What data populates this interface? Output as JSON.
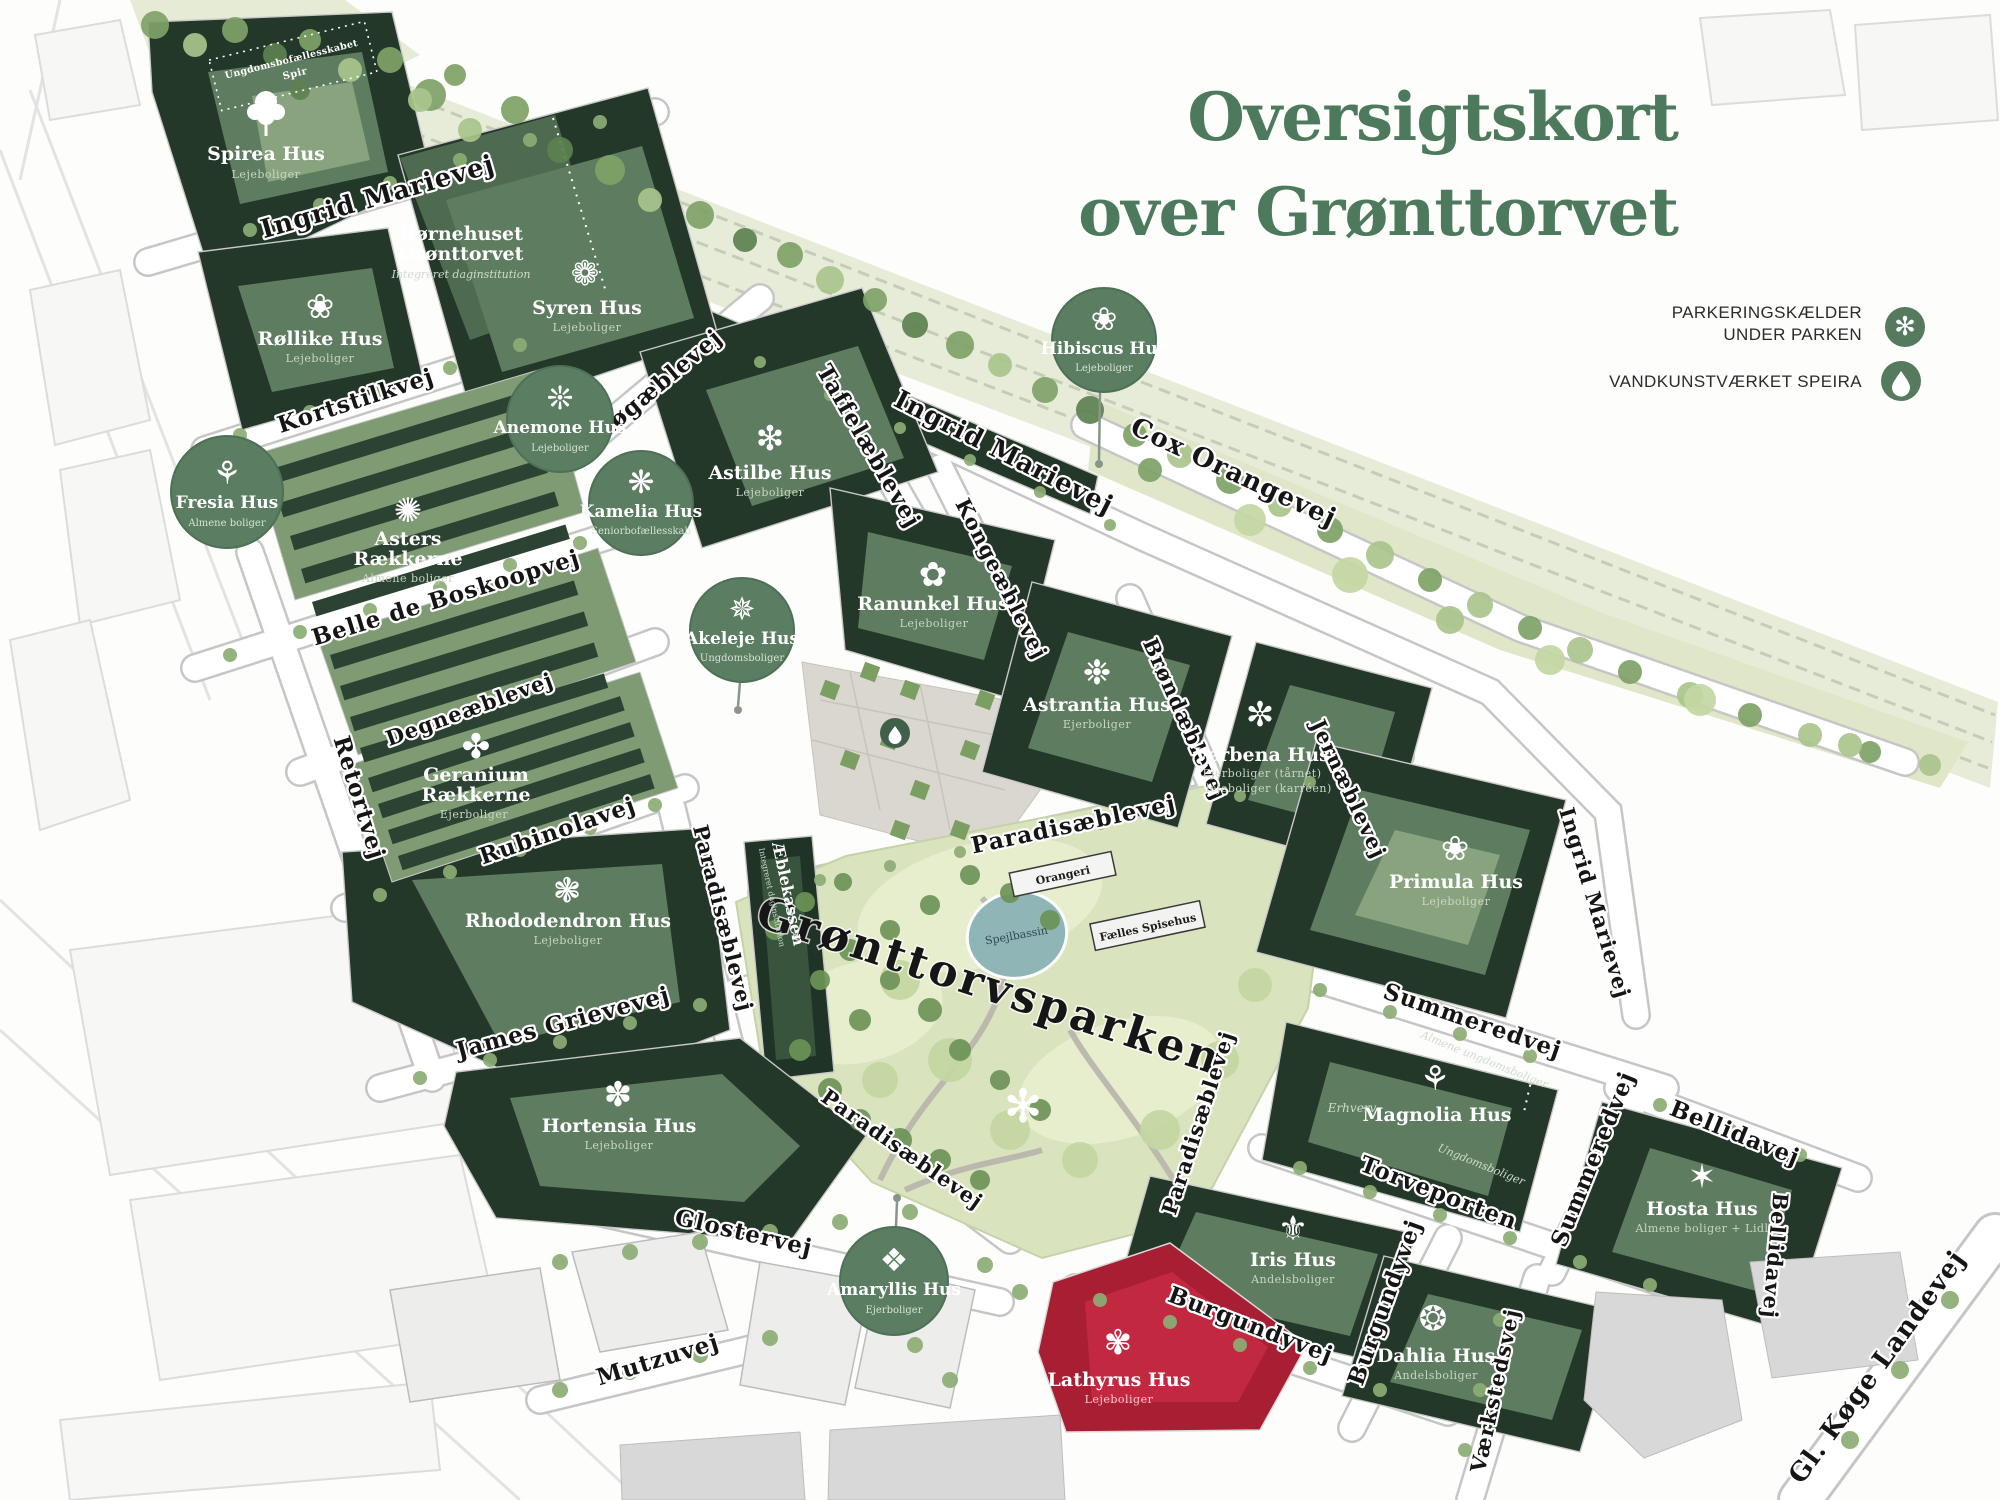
{
  "title": {
    "line1": "Oversigtskort",
    "line2": "over Grønttorvet"
  },
  "legend": [
    {
      "line1": "PARKERINGSKÆLDER",
      "line2": "UNDER PARKEN",
      "icon": "parking-asterisk-icon",
      "glyph": "✻"
    },
    {
      "line1": "VANDKUNSTVÆRKET SPEIRA",
      "line2": "",
      "icon": "water-droplet-icon"
    }
  ],
  "buildings": [
    {
      "name": "Spirea Hus",
      "sub": "Lejeboliger",
      "icon": "tree-icon"
    },
    {
      "name": "Røllike Hus",
      "sub": "Lejeboliger",
      "glyph": "❀",
      "icon": "yarrow-flower-icon"
    },
    {
      "name1": "Børnehuset",
      "name2": "Grønttorvet",
      "sub": "Integreret daginstitution"
    },
    {
      "name": "Syren Hus",
      "sub": "Lejeboliger",
      "glyph": "❁",
      "icon": "lilac-flower-icon"
    },
    {
      "name": "Astilbe Hus",
      "sub": "Lejeboliger",
      "glyph": "❇",
      "icon": "astilbe-fern-icon"
    },
    {
      "name1": "Asters",
      "name2": "Rækkerne",
      "sub": "Almene boliger",
      "glyph": "✺",
      "icon": "aster-flower-icon"
    },
    {
      "name1": "Geranium",
      "name2": "Rækkerne",
      "sub": "Ejerboliger",
      "glyph": "✤",
      "icon": "geranium-flower-icon"
    },
    {
      "name": "Ranunkel Hus",
      "sub": "Lejeboliger",
      "glyph": "✿",
      "icon": "ranunculus-flower-icon"
    },
    {
      "name": "Astrantia Hus",
      "sub": "Ejerboliger",
      "glyph": "❉",
      "icon": "astrantia-flower-icon"
    },
    {
      "name": "Verbena Hus",
      "sub": "Ejerboliger (tårnet)",
      "sub2": "+ lejeboliger (karréen)",
      "glyph": "✼",
      "icon": "verbena-flower-icon"
    },
    {
      "name": "Rhododendron Hus",
      "sub": "Lejeboliger",
      "glyph": "❃",
      "icon": "rhododendron-flower-icon"
    },
    {
      "name": "Primula Hus",
      "sub": "Lejeboliger",
      "glyph": "❀",
      "icon": "primrose-flower-icon"
    },
    {
      "name": "Hortensia Hus",
      "sub": "Lejeboliger",
      "glyph": "✽",
      "icon": "hydrangea-flower-icon"
    },
    {
      "name": "Magnolia Hus",
      "glyph": "⚘",
      "icon": "magnolia-flower-icon",
      "labels": {
        "erhverv": "Erhverv",
        "top": "Almene ungdomsboliger",
        "bottom": "Ungdomsboliger"
      }
    },
    {
      "name": "Hosta Hus",
      "sub": "Almene boliger + Lidl",
      "glyph": "✶",
      "icon": "hosta-flower-icon"
    },
    {
      "name": "Iris Hus",
      "sub": "Andelsboliger",
      "glyph": "⚜",
      "icon": "iris-flower-icon"
    },
    {
      "name": "Dahlia Hus",
      "sub": "Andelsboliger",
      "glyph": "❂",
      "icon": "dahlia-flower-icon"
    },
    {
      "name": "Lathyrus Hus",
      "sub": "Lejeboliger",
      "glyph": "✾",
      "icon": "sweetpea-flower-icon"
    },
    {
      "name": "Æblekassen",
      "sub": "Integreret daginstitution"
    }
  ],
  "badges": [
    {
      "name": "Fresia Hus",
      "sub": "Almene boliger",
      "glyph": "⚘",
      "icon": "freesia-flower-icon"
    },
    {
      "name": "Anemone Hus",
      "sub": "Lejeboliger",
      "glyph": "❊",
      "icon": "anemone-flower-icon"
    },
    {
      "name": "Kamelia Hus",
      "sub": "Seniorbofællesskab",
      "glyph": "❋",
      "icon": "camellia-flower-icon"
    },
    {
      "name": "Akeleje Hus",
      "sub": "Ungdomsboliger",
      "glyph": "✵",
      "icon": "columbine-flower-icon"
    },
    {
      "name": "Hibiscus Hus",
      "sub": "Lejeboliger",
      "glyph": "❀",
      "icon": "hibiscus-flower-icon"
    },
    {
      "name": "Amaryllis Hus",
      "sub": "Ejerboliger",
      "glyph": "❖",
      "icon": "amaryllis-flower-icon"
    }
  ],
  "streets": [
    {
      "label": "Ingrid Marievej"
    },
    {
      "label": "Kortstilkvej"
    },
    {
      "label": "Løgæblevej"
    },
    {
      "label": "Taffelæblevej"
    },
    {
      "label": "Ingrid Marievej"
    },
    {
      "label": "Cox Orangevej"
    },
    {
      "label": "Belle de Boskoopvej"
    },
    {
      "label": "Degneæblevej"
    },
    {
      "label": "Retortvej"
    },
    {
      "label": "Rubinolavej"
    },
    {
      "label": "Kongeæblevej"
    },
    {
      "label": "Brøndæblevej"
    },
    {
      "label": "Paradisæblevej"
    },
    {
      "label": "Jernæblevej"
    },
    {
      "label": "Paradisæblevej"
    },
    {
      "label": "James Grievevej"
    },
    {
      "label": "Paradisæblevej"
    },
    {
      "label": "Glostervej"
    },
    {
      "label": "Mutzuvej"
    },
    {
      "label": "Paradisæblevej"
    },
    {
      "label": "Summeredvej"
    },
    {
      "label": "Summeredvej"
    },
    {
      "label": "Torveporten"
    },
    {
      "label": "Bellidavej"
    },
    {
      "label": "Bellidavej"
    },
    {
      "label": "Burgundyvej"
    },
    {
      "label": "Burgundyvej"
    },
    {
      "label": "Værkstedsvej"
    },
    {
      "label": "Gl. Køge Landevej"
    },
    {
      "label": "Ingrid Marievej"
    }
  ],
  "park": {
    "name": "Grønttorvsparken",
    "pond": "Spejlbassin",
    "orangeri": "Orangeri",
    "spisehus": "Fælles Spisehus"
  },
  "spir": {
    "line1": "Ungdomsbofællesskabet",
    "line2": "Spir"
  },
  "colors": {
    "accent_green": "#4d7a5c",
    "badge_green": "#5b7d62",
    "building_dark": "#243829",
    "building_red": "#a81e33",
    "park_green": "#d9e4be",
    "pond_blue": "#8fb5b7"
  }
}
